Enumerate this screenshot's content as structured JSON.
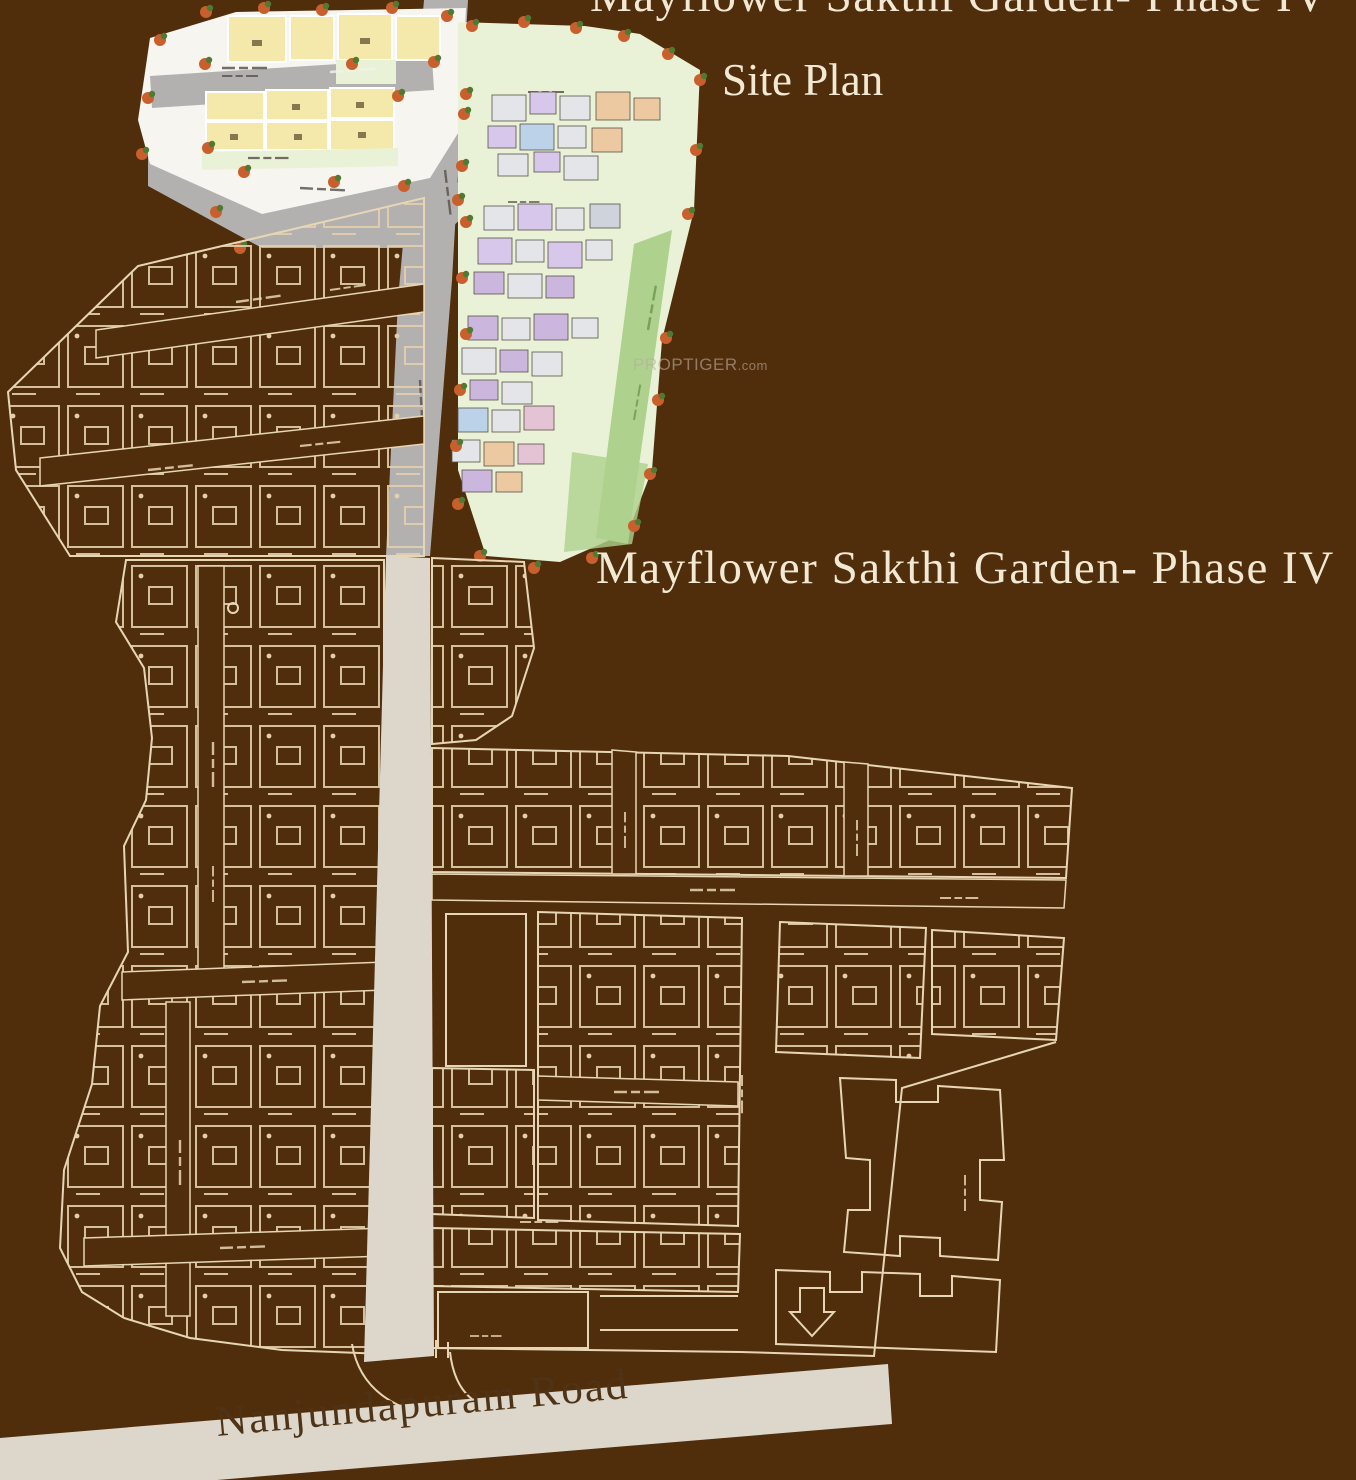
{
  "header": {
    "top_title": "Mayflower Sakthi Garden- Phase IV",
    "subtitle": "Site Plan"
  },
  "map": {
    "project_label": "Mayflower Sakthi Garden- Phase IV",
    "road_label": "Nanjundapuram Road",
    "watermark": {
      "brand": "PROPTIGER",
      "suffix": ".com"
    }
  },
  "colors": {
    "background": "#512E0B",
    "outline": "#E7D6B5",
    "road_gray": "#B3B1B0",
    "road_beige": "#DCD7CA",
    "green_light": "#E9F2D6",
    "green_dark": "#AED18D",
    "plot_yellow": "#F4E9AB",
    "white_area": "#F6F5F0",
    "tree_orange": "#C95F2C",
    "tree_green": "#4E7A34",
    "title_cream": "#F2E9D5",
    "road_text": "#4F3317"
  }
}
